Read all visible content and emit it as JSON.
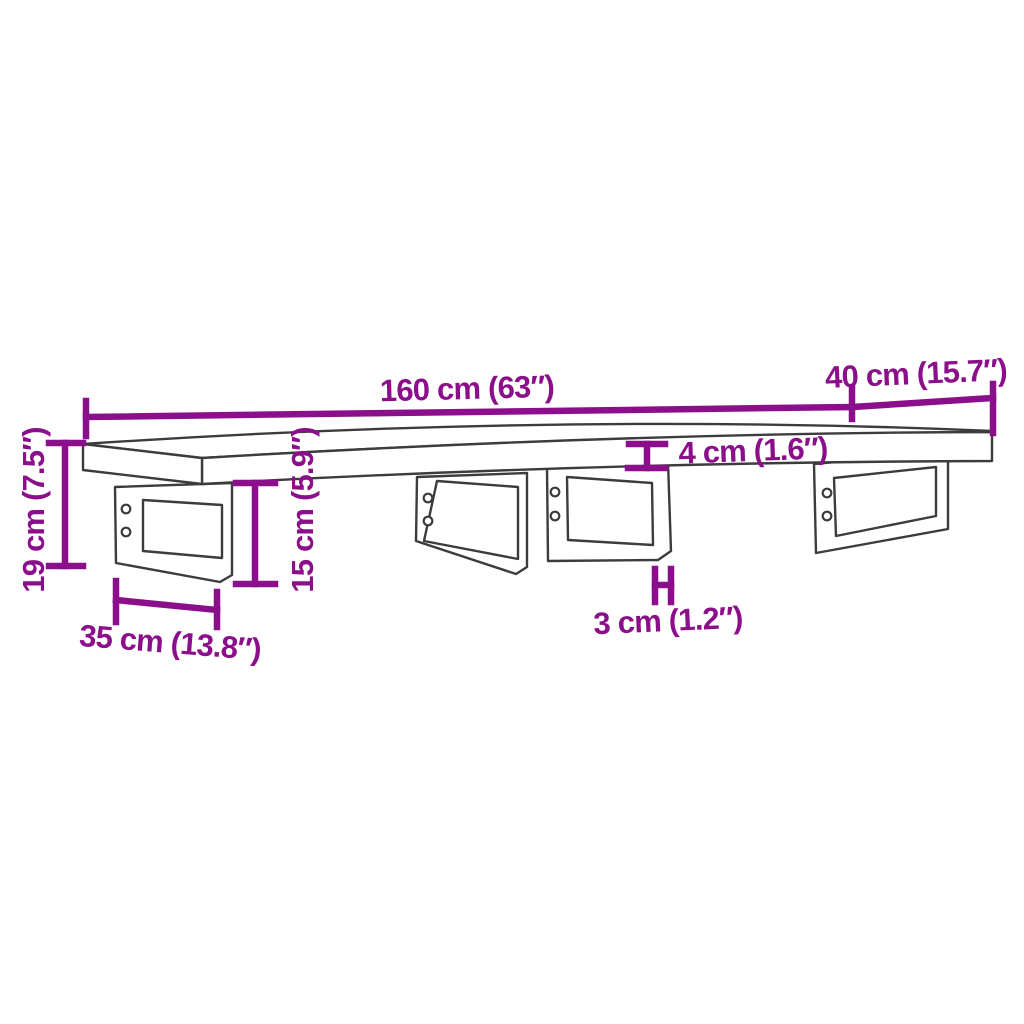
{
  "diagram": {
    "background_color": "#ffffff",
    "outline_color": "#3c3c3c",
    "dimension_color": "#8b0f8a",
    "labels": {
      "length": "160 cm (63″)",
      "depth": "40 cm (15.7″)",
      "thickness": "4 cm (1.6″)",
      "overall_height": "19 cm (7.5″)",
      "bracket_height": "15 cm (5.9″)",
      "bracket_depth": "35 cm (13.8″)",
      "bracket_tube_width": "3 cm (1.2″)"
    }
  }
}
